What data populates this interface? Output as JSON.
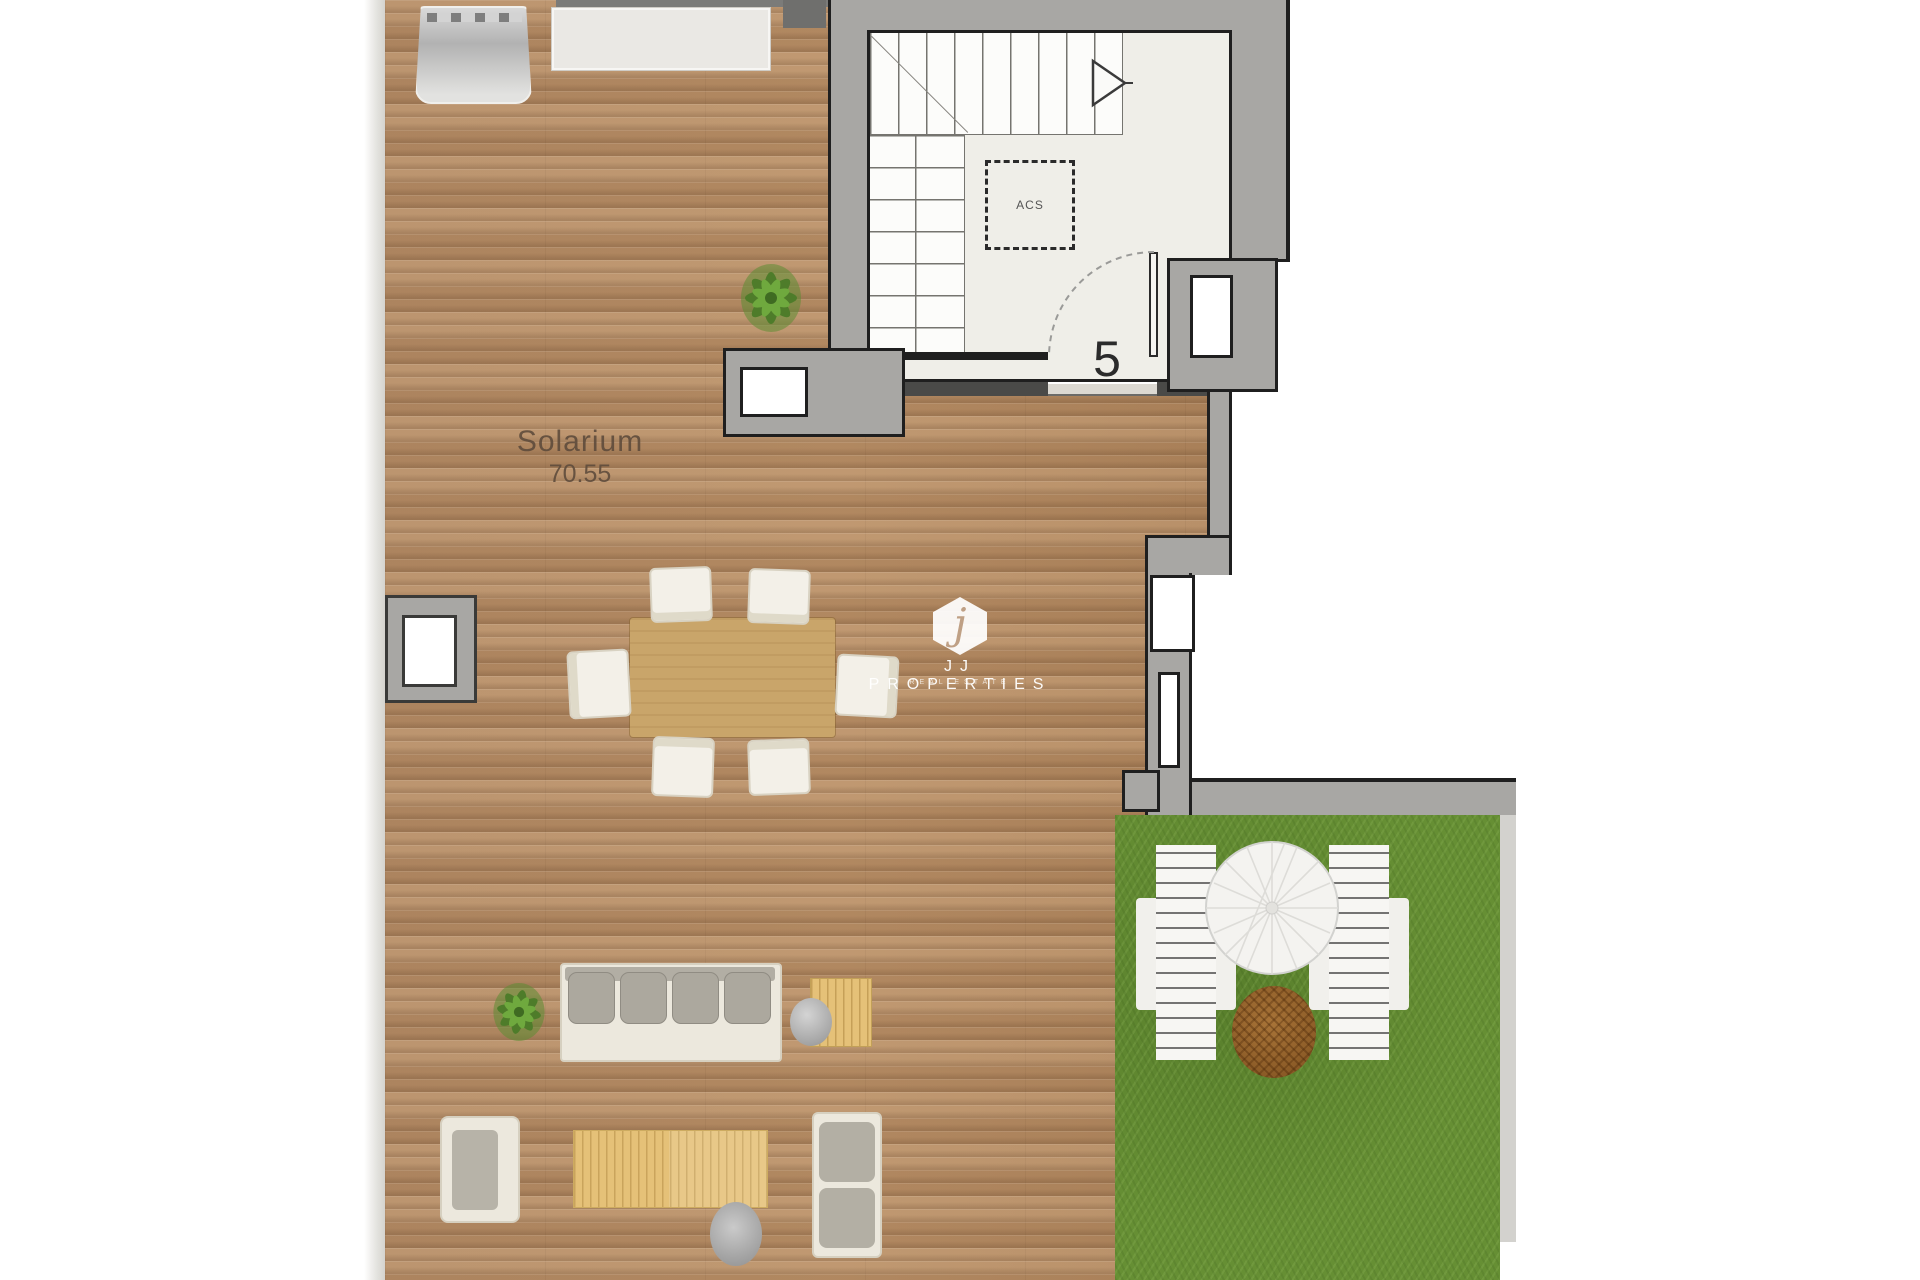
{
  "plan": {
    "room_label": "Solarium",
    "room_area": "70.55",
    "stair_room_number": "5",
    "acs_label": "ACS"
  },
  "watermark": {
    "initial": "j",
    "brand": "JJ PROPERTIES",
    "tagline": "REAL ESTATE"
  },
  "colors": {
    "wood": "#b68d66",
    "wall": "#a8a7a4",
    "line": "#1f1f1f",
    "stair-floor": "#efeee8",
    "grass": "#668f34",
    "tan": "#c9a56a",
    "slat": "#e5c178",
    "cream": "#ece8dd",
    "cushion": "#aca89e",
    "umbrella": "#f3f2ef",
    "soil": "#9a6630",
    "label": "#5f4c3c",
    "watermark": "#ffffff"
  }
}
